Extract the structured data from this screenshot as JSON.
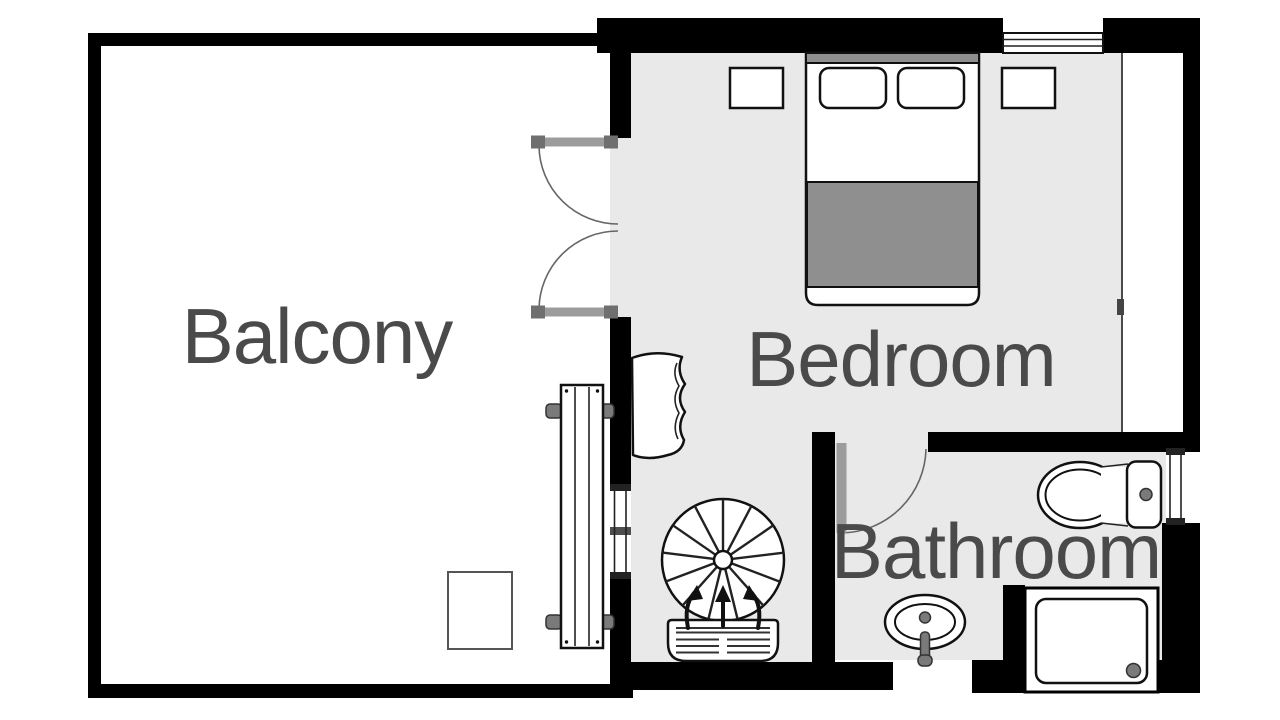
{
  "floor_plan": {
    "rooms": [
      {
        "id": "balcony",
        "label": "Balcony"
      },
      {
        "id": "bedroom",
        "label": "Bedroom"
      },
      {
        "id": "bathroom",
        "label": "Bathroom"
      }
    ],
    "fixtures": [
      "double-bed",
      "pillows",
      "headboard",
      "nightstands",
      "wardrobe-strip",
      "french-doors",
      "balcony-bench",
      "planter-box",
      "armchair",
      "spiral-staircase",
      "stair-entry-mat",
      "direction-arrows",
      "bathroom-door",
      "toilet",
      "sink",
      "shower-tray",
      "windows"
    ],
    "colors": {
      "wall": "#000000",
      "floor": "#e9e9e9",
      "label_text": "#4a4a4a",
      "outline": "#111111",
      "soft_gray": "#8f8f8f",
      "door_leaf": "#9c9c9c",
      "hardware_gray": "#7a7a7a"
    }
  }
}
